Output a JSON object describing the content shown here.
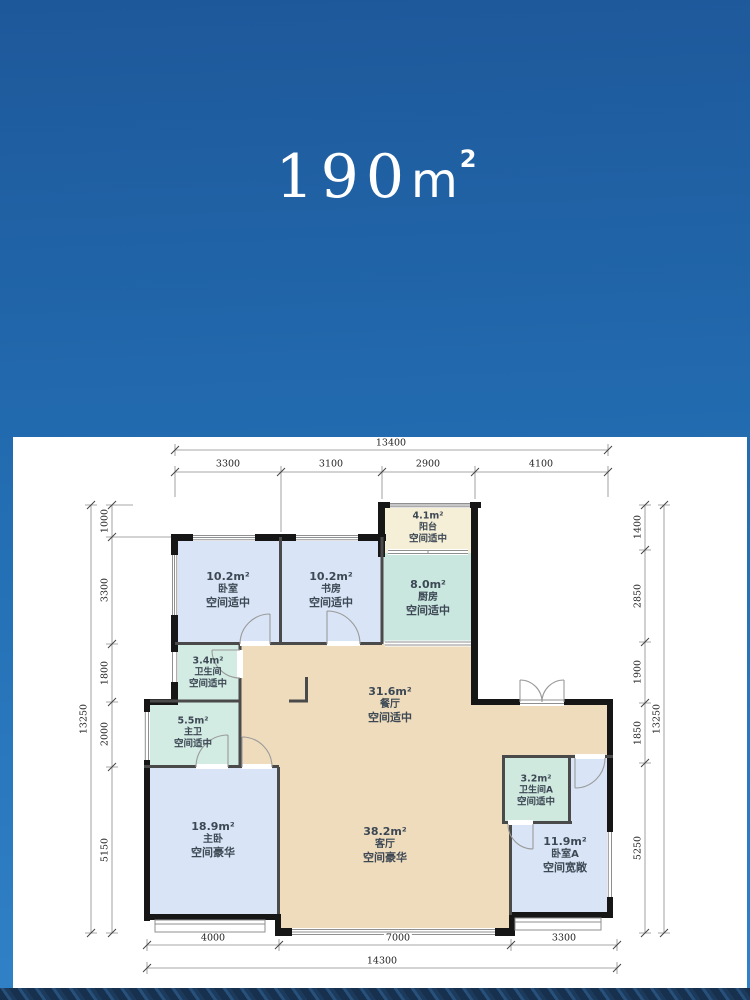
{
  "hero": {
    "number": "190",
    "unit": "m",
    "sup": "2"
  },
  "palette": {
    "hero_blue_top": "#1d589a",
    "hero_blue_bottom": "#3182c8",
    "room_blue": "#d9e5f6",
    "room_teal": "#d2ebe3",
    "room_kitchen_teal": "#c9e6df",
    "room_tan": "#eedcbd",
    "room_cream": "#f4efd6",
    "wall_black": "#161616"
  },
  "plan": {
    "rooms": {
      "bedroom": {
        "area": "10.2m²",
        "name": "卧室",
        "desc": "空间适中"
      },
      "study": {
        "area": "10.2m²",
        "name": "书房",
        "desc": "空间适中"
      },
      "balcony": {
        "area": "4.1m²",
        "name": "阳台",
        "desc": "空间适中"
      },
      "kitchen": {
        "area": "8.0m²",
        "name": "厨房",
        "desc": "空间适中"
      },
      "bath": {
        "area": "3.4m²",
        "name": "卫生间",
        "desc": "空间适中"
      },
      "master_bath": {
        "area": "5.5m²",
        "name": "主卫",
        "desc": "空间适中"
      },
      "dining": {
        "area": "31.6m²",
        "name": "餐厅",
        "desc": "空间适中"
      },
      "master_bedroom": {
        "area": "18.9m²",
        "name": "主卧",
        "desc": "空间豪华"
      },
      "living": {
        "area": "38.2m²",
        "name": "客厅",
        "desc": "空间豪华"
      },
      "bath_a": {
        "area": "3.2m²",
        "name": "卫生间A",
        "desc": "空间适中"
      },
      "bedroom_a": {
        "area": "11.9m²",
        "name": "卧室A",
        "desc": "空间宽敞"
      }
    },
    "dims": {
      "top": {
        "total": "13400",
        "segments": [
          "3300",
          "3100",
          "2900",
          "4100"
        ]
      },
      "bottom": {
        "total": "14300",
        "segments": [
          "4000",
          "7000",
          "3300"
        ]
      },
      "left": {
        "total": "13250",
        "segments": [
          "1000",
          "3300",
          "1800",
          "2000",
          "5150"
        ]
      },
      "right": {
        "total": "13250",
        "segments": [
          "1400",
          "2850",
          "1900",
          "1850",
          "5250"
        ]
      }
    }
  }
}
